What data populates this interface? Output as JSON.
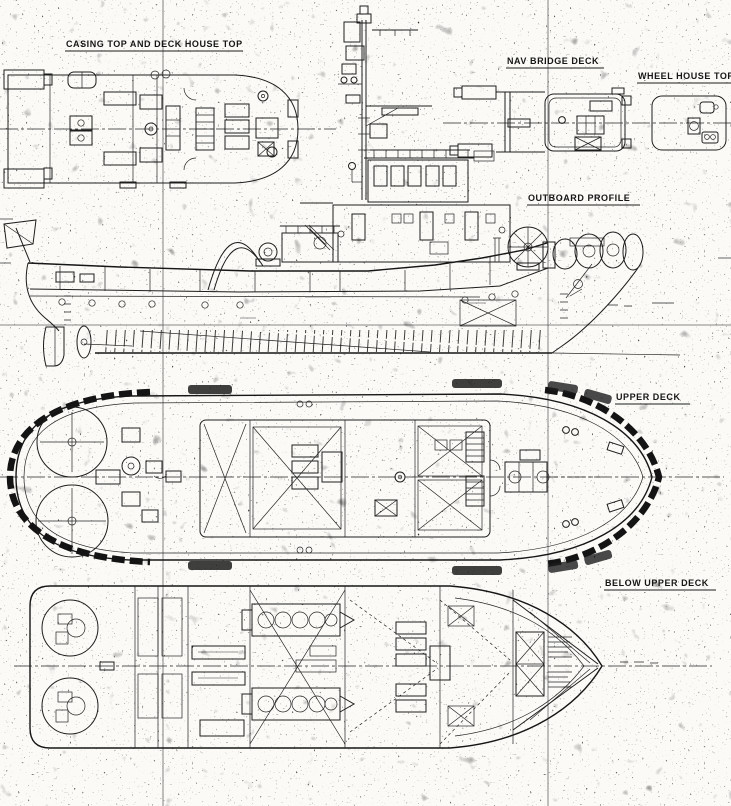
{
  "drawing": {
    "kind": "scanned ship general arrangement drawing",
    "labels": {
      "casing_top": "CASING TOP AND DECK HOUSE TOP",
      "nav_bridge_deck": "NAV BRIDGE DECK",
      "wheel_house_top": "WHEEL HOUSE TOP",
      "outboard_profile": "OUTBOARD PROFILE",
      "upper_deck": "UPPER DECK",
      "below_upper_deck": "BELOW UPPER DECK"
    },
    "colors": {
      "ink": "#1d1d1d",
      "paper": "#fbfaf7"
    }
  }
}
